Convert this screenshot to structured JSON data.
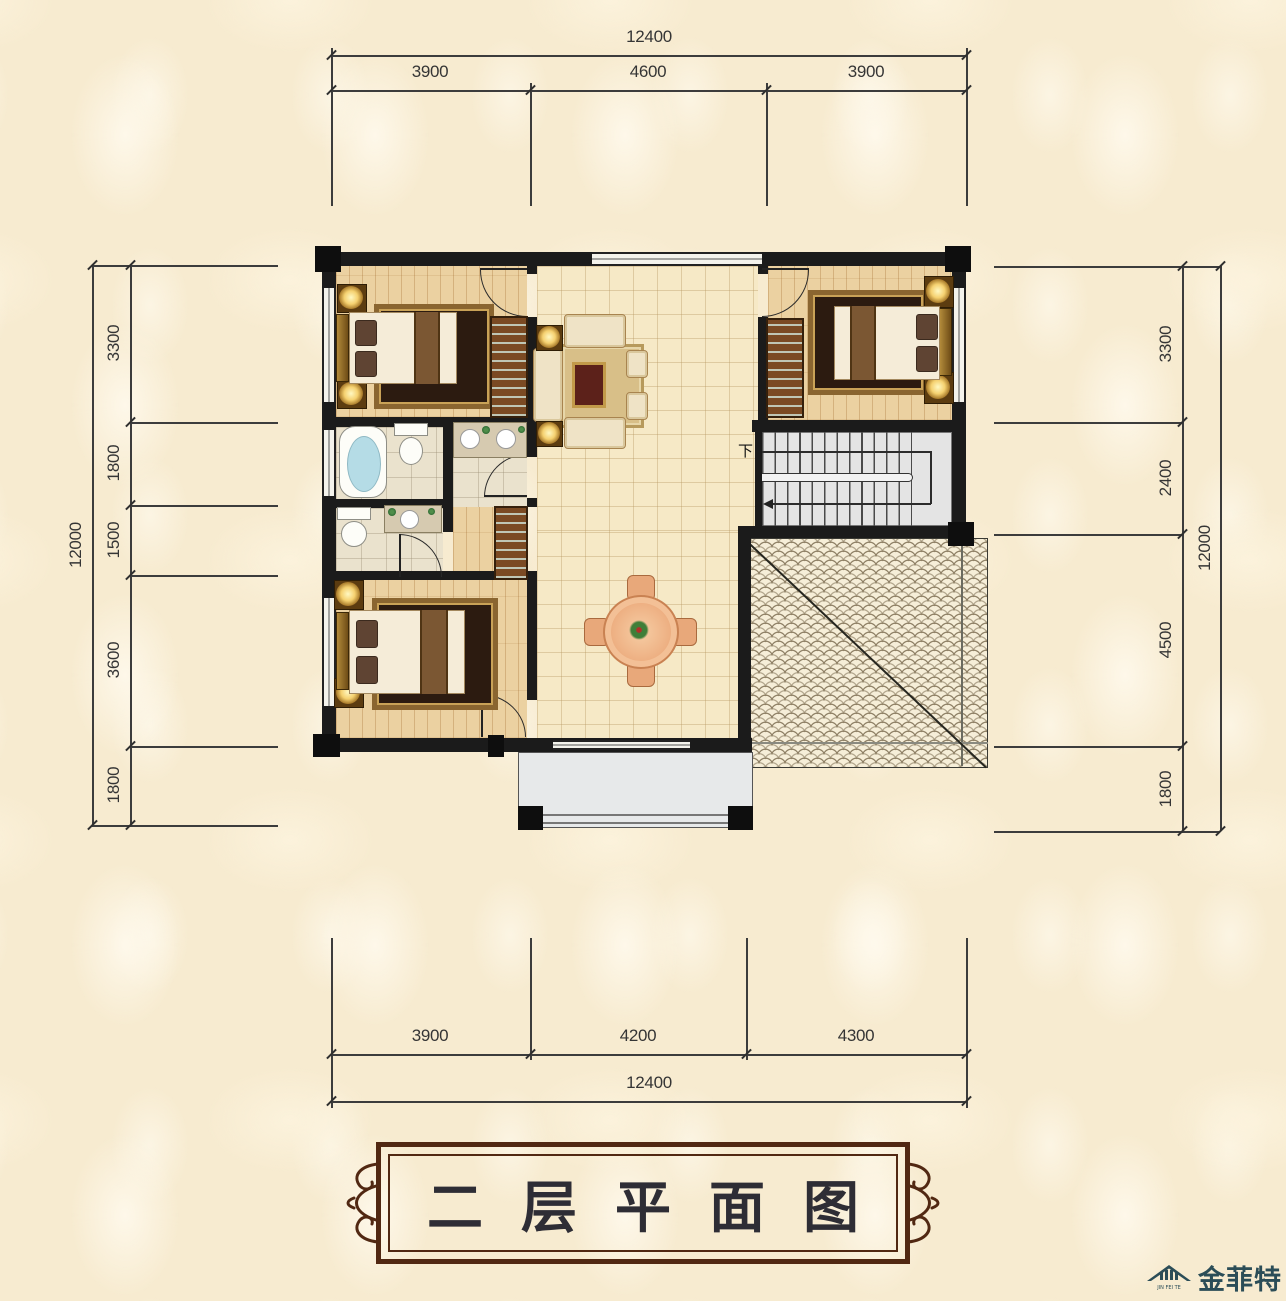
{
  "title_banner": {
    "text": "二层平面图"
  },
  "logo": {
    "brand": "金菲特",
    "pinyin": "JIN FEI TE"
  },
  "stairs": {
    "down_label": "下"
  },
  "dimensions": {
    "top": {
      "total": "12400",
      "segments": [
        "3900",
        "4600",
        "3900"
      ]
    },
    "bottom": {
      "total": "12400",
      "segments": [
        "3900",
        "4200",
        "4300"
      ]
    },
    "left": {
      "total": "12000",
      "segments": [
        "3300",
        "1800",
        "1500",
        "3600",
        "1800"
      ]
    },
    "right": {
      "total": "12000",
      "segments": [
        "3300",
        "2400",
        "4500",
        "1800"
      ]
    }
  },
  "colors": {
    "background": "#f7ebd0",
    "wall": "#1b1b1b",
    "banner_frame": "#512812",
    "logo_teal": "#2b4d57",
    "dimension_text": "#353535"
  }
}
